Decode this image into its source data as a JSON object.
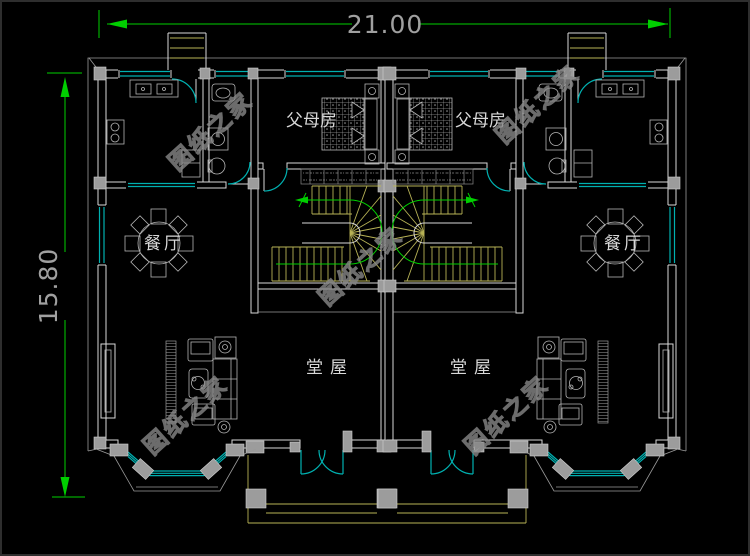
{
  "dimensions": {
    "width_label": "21.00",
    "height_label": "15.80"
  },
  "rooms": {
    "parents_left": "父母房",
    "parents_right": "父母房",
    "dining_left": "餐厅",
    "dining_right": "餐厅",
    "hall_left": "堂屋",
    "hall_right": "堂屋"
  },
  "watermark": {
    "text": "图纸之家"
  },
  "colors": {
    "background": "#000000",
    "wall": "#d9d9d9",
    "outline": "#9a9a9a",
    "window": "#00b0b0",
    "stair": "#b8b356",
    "dimension": "#00cf00",
    "column": "#9c9c9c",
    "furniture": "#b5b5b5",
    "label": "#d8d8d8",
    "dim_text": "#a0a0a0",
    "watermark": "#888888"
  }
}
